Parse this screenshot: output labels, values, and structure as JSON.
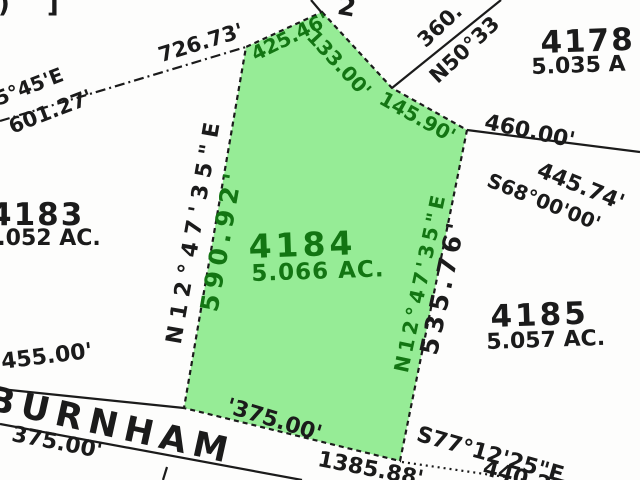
{
  "map": {
    "road": {
      "name": "BURNHAM"
    },
    "subject_parcel": {
      "number": "4184",
      "area": "5.066 AC.",
      "frontage": "'375.00'",
      "edges": {
        "nw_distance": "425.46'",
        "ne_upper_distance": "133.00'",
        "ne_lower_distance": "145.90'",
        "west_bearing": "N12°47'35\"E",
        "west_distance": "590.92'",
        "east_bearing": "N12°47'35\"E",
        "east_distance": "535.76'"
      }
    },
    "adjacent_parcels": [
      {
        "number": "4178",
        "area": "5.035 A"
      },
      {
        "number": "4183",
        "area": "5.052 AC."
      },
      {
        "number": "4185",
        "area": "5.057 AC."
      }
    ],
    "annotations": {
      "corner_fragment": ") ]",
      "top_fragment": "2",
      "top_line_distance": "726.73'",
      "left_bearing_fragment": "5°45'E",
      "left_distance": "601.27'",
      "ne_line_distance": "360.",
      "ne_line_bearing": "N50°33",
      "east_line_distance": "460.00'",
      "right_distance": "445.74'",
      "right_bearing": "S68°00'00'",
      "road_front_left": "455.00'",
      "road_below_left": "375.00'",
      "road_total": "1385.88'",
      "road_bearing": "S77°12'25\"E",
      "road_right_distance": "440.25'"
    }
  },
  "colors": {
    "parcel_fill": "#96EC96",
    "parcel_text": "#137513",
    "ink": "#1b1b1b",
    "background": "#fdfdfc"
  }
}
